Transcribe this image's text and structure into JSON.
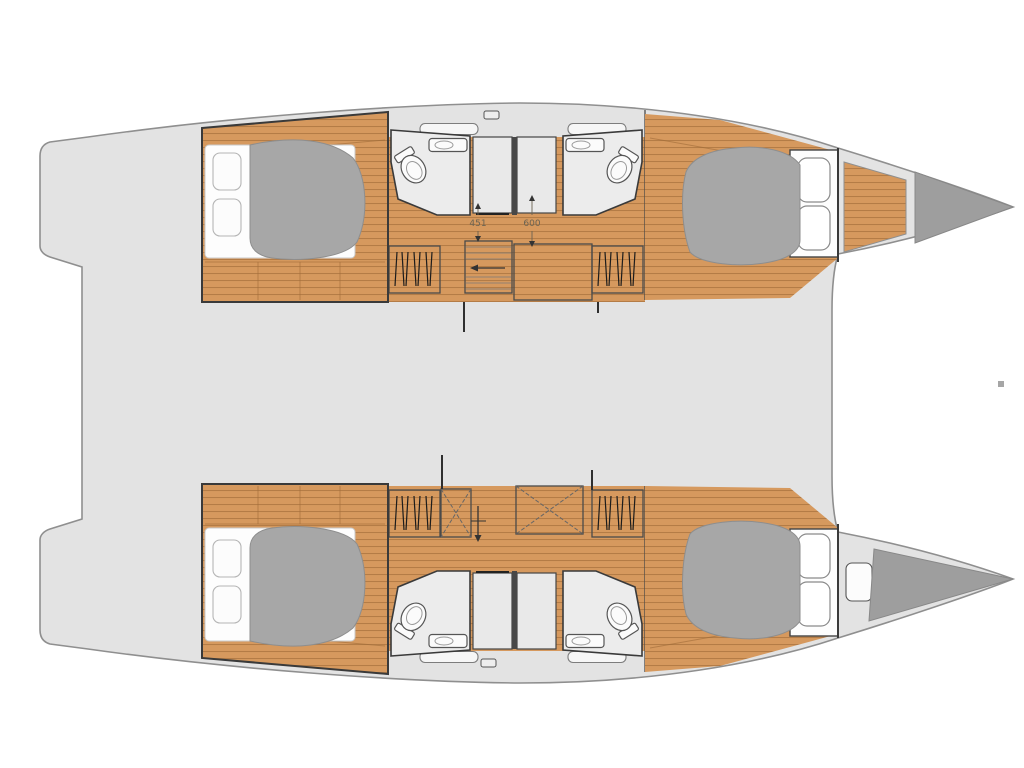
{
  "floorplan": {
    "dimension_labels": [
      {
        "name": "dim-451",
        "text": "451"
      },
      {
        "name": "dim-600",
        "text": "600"
      }
    ],
    "palette": {
      "background": "#ffffff",
      "deck": "#e3e3e3",
      "hull_outline": "#8f8f8f",
      "interior_wall": "#3a3a3a",
      "wood_floor": "#d6995e",
      "wood_plank_line": "#a06c38",
      "bed_cover": "#a7a7a7",
      "mattress": "#fdfdfd",
      "bathroom_floor": "#ececec",
      "bow_locker": "#9e9e9e"
    }
  }
}
